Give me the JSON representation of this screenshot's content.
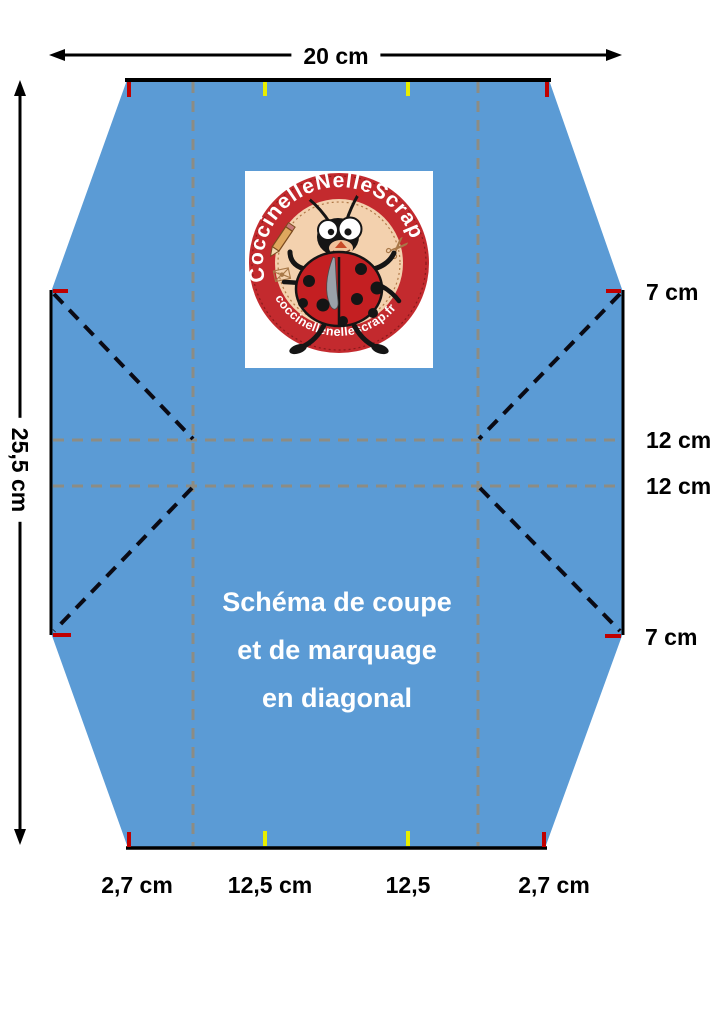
{
  "title": "Schéma de coupe et de marquage en diagonal",
  "colors": {
    "paper_blue": "#5b9bd5",
    "fold_line_gray": "#8c8c84",
    "cut_line_black": "#000000",
    "mark_red": "#c00000",
    "mark_yellow": "#e8ee00",
    "caption_white": "#ffffff",
    "badge_red": "#c32a2e",
    "badge_peach": "#f3d1ae"
  },
  "dimensions": {
    "top_width": "20 cm",
    "left_height": "25,5 cm",
    "right": {
      "top_corner": "7 cm",
      "upper_middle": "12 cm",
      "lower_middle": "12 cm",
      "bottom_corner": "7 cm"
    },
    "bottom": {
      "left_corner": "2,7 cm",
      "left_middle": "12,5 cm",
      "right_middle": "12,5",
      "right_corner": "2,7 cm"
    }
  },
  "caption": {
    "line1": "Schéma de coupe",
    "line2": "et de marquage",
    "line3": "en diagonal"
  },
  "logo": {
    "arc_top": "CoccinelleNelleScrap",
    "arc_bottom": "coccinellenellescrap.fr"
  },
  "icons": {
    "scissors": "✂",
    "envelope": "✉"
  }
}
